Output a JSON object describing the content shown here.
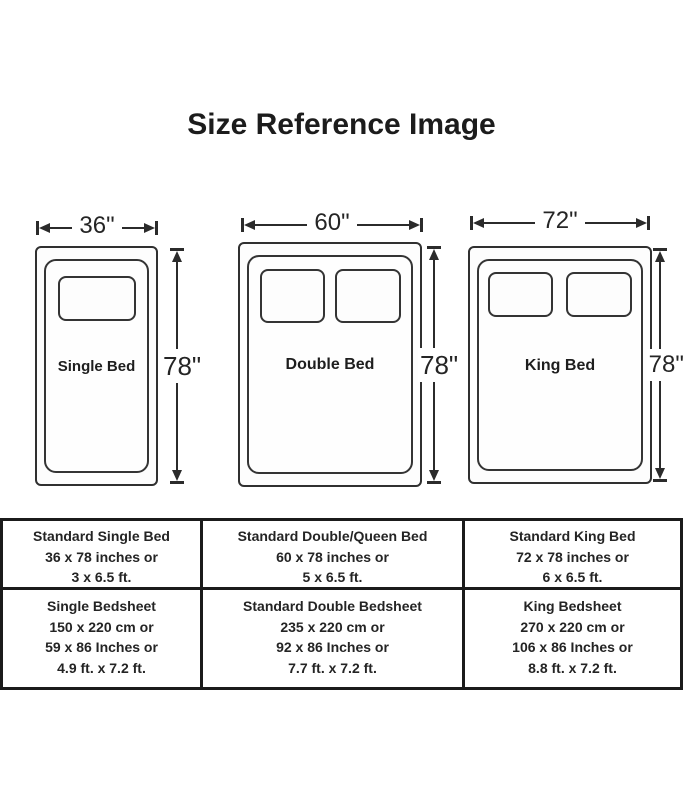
{
  "title": "Size Reference Image",
  "beds": [
    {
      "name": "Single Bed",
      "width_label": "36\"",
      "height_label": "78\"",
      "pillows": 1
    },
    {
      "name": "Double Bed",
      "width_label": "60\"",
      "height_label": "78\"",
      "pillows": 2
    },
    {
      "name": "King Bed",
      "width_label": "72\"",
      "height_label": "78\"",
      "pillows": 2
    }
  ],
  "table": {
    "rows": [
      {
        "cells": [
          {
            "lines": [
              "Standard Single Bed",
              "36 x 78 inches or",
              "3 x 6.5 ft."
            ]
          },
          {
            "lines": [
              "Standard Double/Queen Bed",
              "60 x 78 inches or",
              "5 x 6.5 ft."
            ]
          },
          {
            "lines": [
              "Standard King Bed",
              "72 x 78 inches or",
              "6 x 6.5 ft."
            ]
          }
        ]
      },
      {
        "cells": [
          {
            "lines": [
              "Single Bedsheet",
              "150 x 220 cm or",
              "59 x 86 Inches or",
              "4.9 ft. x 7.2 ft."
            ]
          },
          {
            "lines": [
              "Standard Double Bedsheet",
              "235 x 220 cm or",
              "92 x 86 Inches or",
              "7.7 ft. x 7.2 ft."
            ]
          },
          {
            "lines": [
              "King Bedsheet",
              "270 x 220 cm or",
              "106 x 86 Inches or",
              "8.8 ft. x 7.2 ft."
            ]
          }
        ]
      }
    ]
  },
  "colors": {
    "ink": "#222222",
    "background": "#ffffff"
  }
}
